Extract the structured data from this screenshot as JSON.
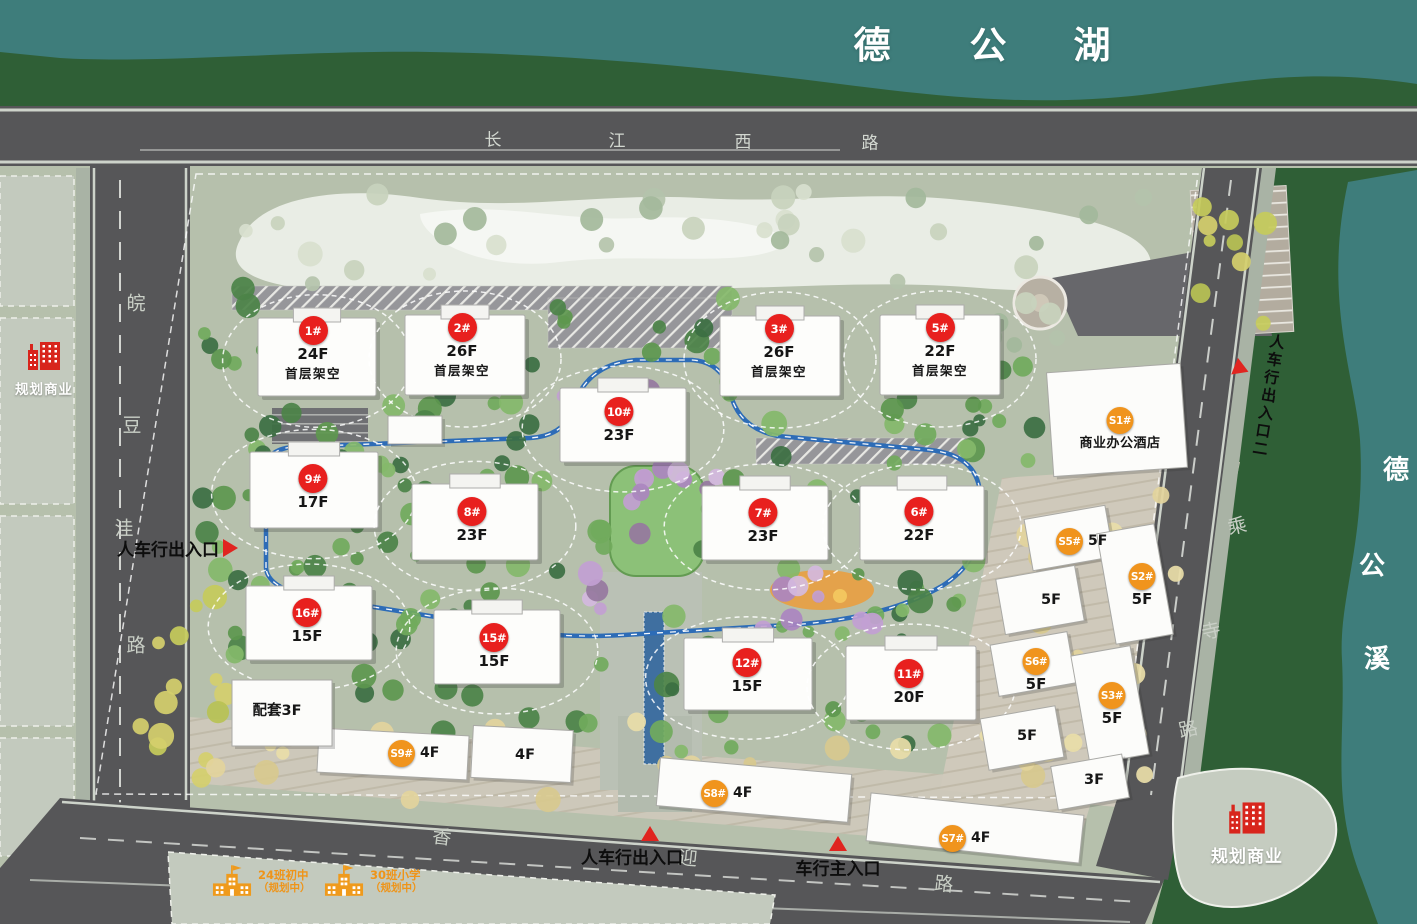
{
  "map": {
    "lake": {
      "name": "德公湖",
      "chars": [
        "德",
        "公",
        "湖"
      ]
    },
    "creek": {
      "name": "德公溪",
      "chars": [
        "德",
        "公",
        "溪"
      ]
    },
    "roads": {
      "north": {
        "name": "长江西路",
        "chars": [
          "长",
          "江",
          "西",
          "路"
        ]
      },
      "west": {
        "name": "皖豆洼路",
        "chars": [
          "皖",
          "豆",
          "洼",
          "路"
        ]
      },
      "east": {
        "name": "乘寺路",
        "chars": [
          "乘",
          "寺",
          "路"
        ]
      },
      "south": {
        "name": "香迎路",
        "chars": [
          "香",
          "迎",
          "路"
        ]
      }
    }
  },
  "legend_colors": {
    "residential_badge": "#e8201e",
    "commercial_badge": "#f0941d",
    "poi_red": "#d8251c",
    "school_orange": "#ef9a1c",
    "track_blue": "#2d6cb7",
    "lake_teal": "#3e7d7b"
  },
  "buildings": {
    "residential": [
      {
        "id": "1#",
        "floors": "24F",
        "note": "首层架空",
        "x": 313,
        "y": 330
      },
      {
        "id": "2#",
        "floors": "26F",
        "note": "首层架空",
        "x": 462,
        "y": 327
      },
      {
        "id": "3#",
        "floors": "26F",
        "note": "首层架空",
        "x": 779,
        "y": 328
      },
      {
        "id": "5#",
        "floors": "22F",
        "note": "首层架空",
        "x": 940,
        "y": 327
      },
      {
        "id": "10#",
        "floors": "23F",
        "x": 619,
        "y": 411
      },
      {
        "id": "9#",
        "floors": "17F",
        "x": 313,
        "y": 478
      },
      {
        "id": "8#",
        "floors": "23F",
        "x": 472,
        "y": 511
      },
      {
        "id": "7#",
        "floors": "23F",
        "x": 763,
        "y": 512
      },
      {
        "id": "6#",
        "floors": "22F",
        "x": 919,
        "y": 511
      },
      {
        "id": "16#",
        "floors": "15F",
        "x": 307,
        "y": 612
      },
      {
        "id": "15#",
        "floors": "15F",
        "x": 494,
        "y": 637
      },
      {
        "id": "12#",
        "floors": "15F",
        "x": 747,
        "y": 662
      },
      {
        "id": "11#",
        "floors": "20F",
        "x": 909,
        "y": 673
      }
    ],
    "commercial": [
      {
        "id": "S1#",
        "note": "商业办公酒店",
        "x": 1120,
        "y": 420
      },
      {
        "id": "S5#",
        "floors": "5F",
        "floors_side": true,
        "x": 1069,
        "y": 541
      },
      {
        "id": "S2#",
        "floors": "5F",
        "x": 1142,
        "y": 576
      },
      {
        "id": "S6#",
        "floors": "5F",
        "x": 1036,
        "y": 661
      },
      {
        "id": "S3#",
        "floors": "5F",
        "x": 1112,
        "y": 695
      },
      {
        "id": "S9#",
        "floors": "4F",
        "floors_side": true,
        "x": 401,
        "y": 753
      },
      {
        "id": "S8#",
        "floors": "4F",
        "floors_side": true,
        "x": 714,
        "y": 793
      },
      {
        "id": "S7#",
        "floors": "4F",
        "floors_side": true,
        "x": 952,
        "y": 838
      }
    ],
    "plain": [
      {
        "text": "配套3F",
        "x": 277,
        "y": 709
      },
      {
        "text": "4F",
        "x": 525,
        "y": 757
      },
      {
        "text": "5F",
        "x": 1051,
        "y": 602
      },
      {
        "text": "5F",
        "x": 1027,
        "y": 738
      },
      {
        "text": "3F",
        "x": 1094,
        "y": 782
      }
    ]
  },
  "entrances": [
    {
      "label": "人车行出入口",
      "side": "west"
    },
    {
      "label": "人车行出入口二",
      "side": "northeast"
    },
    {
      "label": "人车行出入口",
      "side": "south"
    },
    {
      "label": "车行主入口",
      "side": "south-main"
    }
  ],
  "poi": [
    {
      "label": "规划商业",
      "type": "commerce",
      "side": "northwest"
    },
    {
      "label": "规划商业",
      "type": "commerce",
      "side": "southeast"
    },
    {
      "label": "24班初中",
      "sub": "（规划中）",
      "type": "school"
    },
    {
      "label": "30班小学",
      "sub": "（规划中）",
      "type": "school"
    }
  ]
}
